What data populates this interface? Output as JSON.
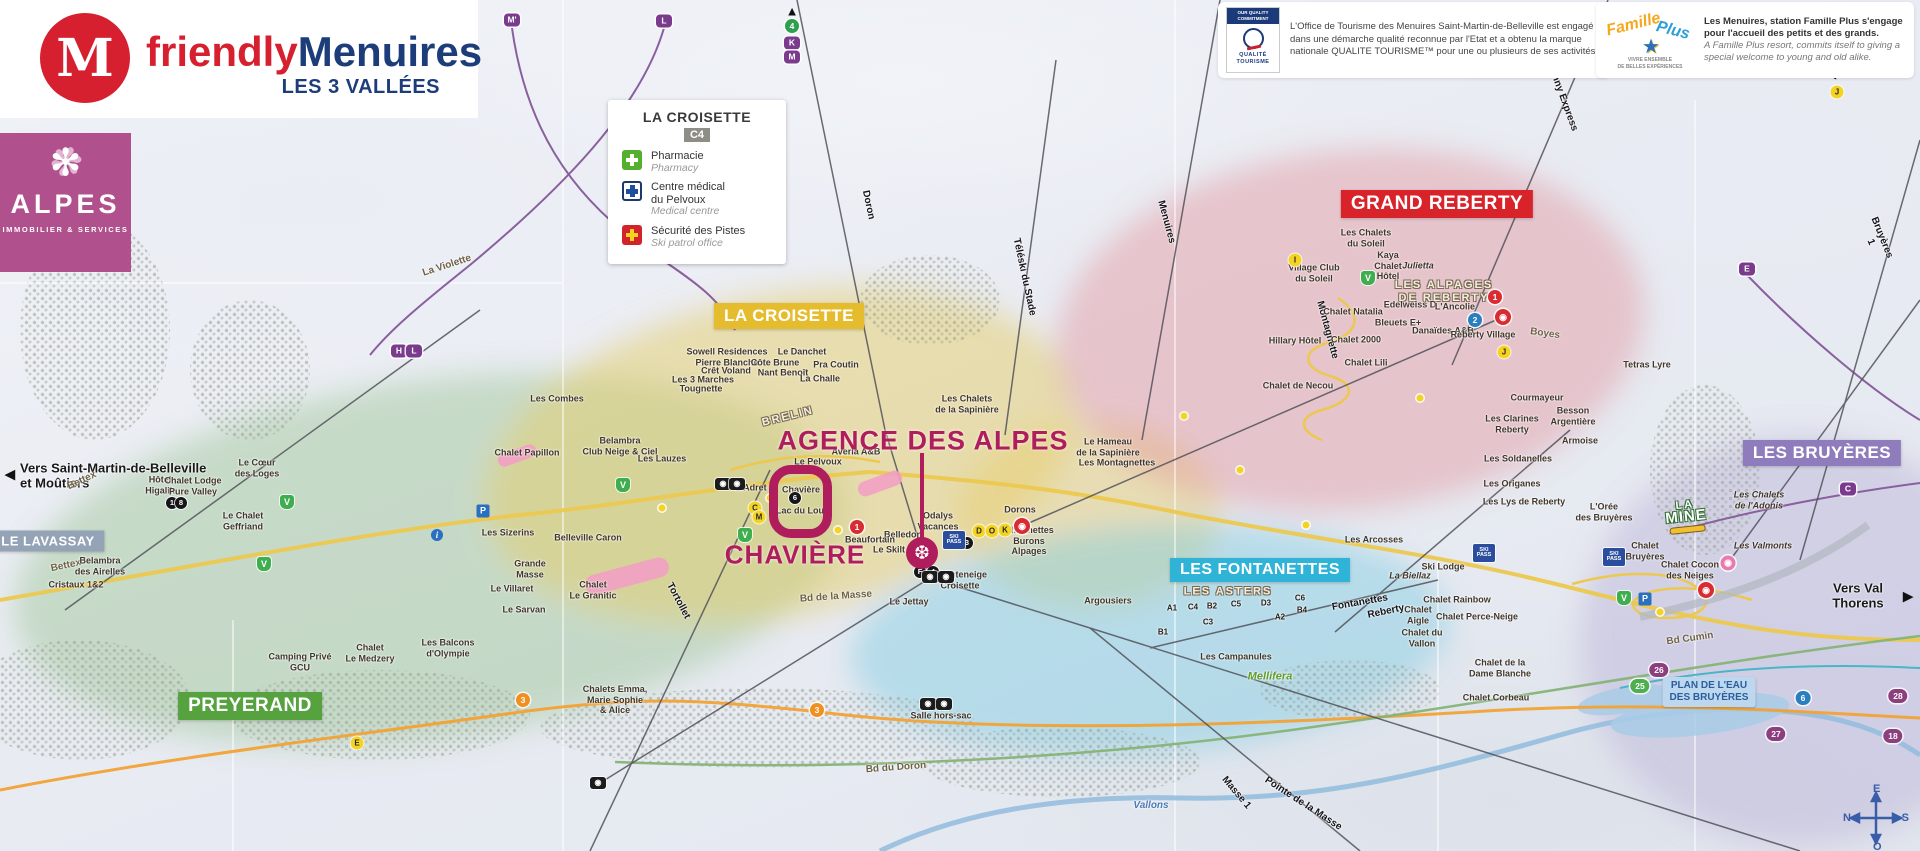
{
  "brand": {
    "logo_letter": "M",
    "friendly": "friendly",
    "menuires": "Menuires",
    "tagline": "LES 3 VALLÉES"
  },
  "alpes": {
    "name": "ALPES",
    "subtitle": "IMMOBILIER & SERVICES"
  },
  "legend": {
    "title": "LA CROISETTE",
    "grid": "C4",
    "items": [
      {
        "icon": "pharmacy-cross",
        "fr": "Pharmacie",
        "en": "Pharmacy"
      },
      {
        "icon": "medical-cross",
        "fr": "Centre médical\ndu Pelvoux",
        "en": "Medical centre"
      },
      {
        "icon": "ski-patrol-cross",
        "fr": "Sécurité des Pistes",
        "en": "Ski patrol office"
      }
    ]
  },
  "quality": {
    "header": "OUR QUALITY COMMITMENT",
    "logo": "QUALITÉ TOURISME",
    "text": "L'Office de Tourisme des Menuires Saint-Martin-de-Belleville est engagé dans une démarche qualité reconnue par l'Etat et a obtenu la marque nationale QUALITE TOURISME™ pour une ou plusieurs de ses activités."
  },
  "famille": {
    "logo_fam": "Famille",
    "logo_plus": "Plus",
    "logo_star": "★",
    "logo_sub": "VIVRE ENSEMBLE\nDE BELLES EXPÉRIENCES",
    "text_fr": "Les Menuires, station Famille Plus s'engage pour l'accueil des petits et des grands.",
    "text_en": "A Famille Plus resort, commits itself to giving a special welcome to young and old alike."
  },
  "annotation": {
    "agency": "AGENCE DES ALPES",
    "district": "CHAVIÈRE",
    "marker_icon": "❆"
  },
  "special": {
    "plan_eau": "PLAN DE L'EAU\nDES BRUYÈRES",
    "la_mine_1": "LA",
    "la_mine_2": "MINE",
    "mellifera": "Mellifera",
    "compass": {
      "n": "N",
      "e": "E",
      "s": "S",
      "o": "O"
    }
  },
  "zones": [
    {
      "t": "LA CROISETTE",
      "x": 789,
      "y": 316,
      "bg": "#e6bc2f",
      "s": 17
    },
    {
      "t": "GRAND REBERTY",
      "x": 1437,
      "y": 204,
      "bg": "#d8232a",
      "s": 19
    },
    {
      "t": "LES BRUYÈRES",
      "x": 1822,
      "y": 453,
      "bg": "#8f7cbc",
      "s": 17
    },
    {
      "t": "LES FONTANETTES",
      "x": 1260,
      "y": 570,
      "bg": "#2fb4d8",
      "s": 16
    },
    {
      "t": "PREYERAND",
      "x": 250,
      "y": 706,
      "bg": "#55a23e",
      "s": 19
    },
    {
      "t": "LE LAVASSAY",
      "x": 48,
      "y": 541,
      "bg": "#95a3b6",
      "s": 13
    }
  ],
  "labels": [
    {
      "t": "Vers Saint-Martin-de-Belleville\net Moûtiers",
      "x": 20,
      "y": 476,
      "cls": "left bold13"
    },
    {
      "t": "Vers Val Thorens",
      "x": 1858,
      "y": 596,
      "cls": "bold13"
    },
    {
      "t": "La Violette",
      "x": 447,
      "y": 266,
      "cls": "road",
      "rot": -18
    },
    {
      "t": "Bettex",
      "x": 82,
      "y": 481,
      "cls": "road",
      "rot": -25
    },
    {
      "t": "Bettex",
      "x": 66,
      "y": 566,
      "cls": "road",
      "rot": -12
    },
    {
      "t": "Doron",
      "x": 868,
      "y": 205,
      "cls": "lift",
      "rot": 78
    },
    {
      "t": "Menuires",
      "x": 1166,
      "y": 222,
      "cls": "lift",
      "rot": 75
    },
    {
      "t": "Téléski du Stade",
      "x": 1024,
      "y": 277,
      "cls": "lift",
      "rot": 78
    },
    {
      "t": "Sunny Express",
      "x": 1562,
      "y": 97,
      "cls": "lift",
      "rot": 70
    },
    {
      "t": "Bruyères 1",
      "x": 1876,
      "y": 240,
      "cls": "lift",
      "rot": 68
    },
    {
      "t": "Tortollet",
      "x": 678,
      "y": 601,
      "cls": "lift",
      "rot": 62
    },
    {
      "t": "Masse 1",
      "x": 1236,
      "y": 793,
      "cls": "lift",
      "rot": 50
    },
    {
      "t": "Pointe de la Masse",
      "x": 1303,
      "y": 804,
      "cls": "lift",
      "rot": 33
    },
    {
      "t": "Fontanettes",
      "x": 1360,
      "y": 603,
      "cls": "lift",
      "rot": -10
    },
    {
      "t": "Reberty",
      "x": 1386,
      "y": 612,
      "cls": "lift",
      "rot": -12
    },
    {
      "t": "Montagnette",
      "x": 1327,
      "y": 330,
      "cls": "lift",
      "rot": 75
    },
    {
      "t": "Bd de la Masse",
      "x": 836,
      "y": 597,
      "cls": "road",
      "rot": -4
    },
    {
      "t": "Bd du Doron",
      "x": 896,
      "y": 768,
      "cls": "road",
      "rot": -4
    },
    {
      "t": "Bd Cumin",
      "x": 1690,
      "y": 639,
      "cls": "road",
      "rot": -8
    },
    {
      "t": "Boyes",
      "x": 1545,
      "y": 334,
      "cls": "road",
      "rot": 8
    },
    {
      "t": "Vallons",
      "x": 1151,
      "y": 806,
      "cls": "river"
    },
    {
      "t": "Sowell Residences\nPierre Blanche",
      "x": 727,
      "y": 357
    },
    {
      "t": "Crêt Voland",
      "x": 726,
      "y": 371
    },
    {
      "t": "Les 3 Marches",
      "x": 703,
      "y": 380
    },
    {
      "t": "Tougnette",
      "x": 701,
      "y": 389
    },
    {
      "t": "Les Combes",
      "x": 557,
      "y": 399
    },
    {
      "t": "Côte Brune",
      "x": 775,
      "y": 363
    },
    {
      "t": "Nant Benoît",
      "x": 783,
      "y": 373
    },
    {
      "t": "Le Danchet",
      "x": 802,
      "y": 352
    },
    {
      "t": "Pra Coutin",
      "x": 836,
      "y": 365
    },
    {
      "t": "La Challe",
      "x": 820,
      "y": 379
    },
    {
      "t": "BRELIN",
      "x": 788,
      "y": 417,
      "cls": "outline",
      "rot": -14
    },
    {
      "t": "Chalet Papillon",
      "x": 527,
      "y": 453
    },
    {
      "t": "Belambra\nClub Neige & Ciel",
      "x": 620,
      "y": 446
    },
    {
      "t": "Les Lauzes",
      "x": 662,
      "y": 459
    },
    {
      "t": "Le Pelvoux",
      "x": 818,
      "y": 462
    },
    {
      "t": "Averia A&B",
      "x": 856,
      "y": 452
    },
    {
      "t": "L'Adret",
      "x": 751,
      "y": 488
    },
    {
      "t": "Chavière",
      "x": 801,
      "y": 490
    },
    {
      "t": "Lac du Lou",
      "x": 800,
      "y": 511
    },
    {
      "t": "Odalys\nVacances",
      "x": 938,
      "y": 521
    },
    {
      "t": "Belledon",
      "x": 903,
      "y": 535
    },
    {
      "t": "Beaufortain",
      "x": 870,
      "y": 540
    },
    {
      "t": "Le Skilt",
      "x": 889,
      "y": 550
    },
    {
      "t": "Dorons",
      "x": 1020,
      "y": 510
    },
    {
      "t": "Charmettes\nBurons\nAlpages",
      "x": 1029,
      "y": 541
    },
    {
      "t": "Chanteneige\nCroisette",
      "x": 960,
      "y": 580
    },
    {
      "t": "Le Jettay",
      "x": 909,
      "y": 602
    },
    {
      "t": "Salle hors-sac",
      "x": 941,
      "y": 716
    },
    {
      "t": "Le Cœur\ndes Loges",
      "x": 257,
      "y": 468
    },
    {
      "t": "Hôtel\nHigalik",
      "x": 160,
      "y": 485
    },
    {
      "t": "Chalet Lodge\nPure Valley",
      "x": 193,
      "y": 486
    },
    {
      "t": "Le Chalet\nGeffriand",
      "x": 243,
      "y": 521
    },
    {
      "t": "Les Sizerins",
      "x": 508,
      "y": 533
    },
    {
      "t": "Belleville Caron",
      "x": 588,
      "y": 538
    },
    {
      "t": "Grande\nMasse",
      "x": 530,
      "y": 569
    },
    {
      "t": "Le Villaret",
      "x": 512,
      "y": 589
    },
    {
      "t": "Chalet\nLe Granitic",
      "x": 593,
      "y": 590
    },
    {
      "t": "Le Sarvan",
      "x": 524,
      "y": 610
    },
    {
      "t": "Belambra\ndes Airelles",
      "x": 100,
      "y": 566
    },
    {
      "t": "Cristaux 1&2",
      "x": 76,
      "y": 585
    },
    {
      "t": "Camping Privé\nGCU",
      "x": 300,
      "y": 662
    },
    {
      "t": "Les Balcons\nd'Olympie",
      "x": 448,
      "y": 648
    },
    {
      "t": "Chalet\nLe Medzery",
      "x": 370,
      "y": 653
    },
    {
      "t": "Chalets Emma,\nMarie Sophie\n& Alice",
      "x": 615,
      "y": 700
    },
    {
      "t": "LES ASTERS",
      "x": 1228,
      "y": 592,
      "cls": "outline"
    },
    {
      "t": "Les Campanules",
      "x": 1236,
      "y": 657
    },
    {
      "t": "Argousiers",
      "x": 1108,
      "y": 601
    },
    {
      "t": "A1",
      "x": 1172,
      "y": 608,
      "cls": "tiny"
    },
    {
      "t": "C4",
      "x": 1193,
      "y": 607,
      "cls": "tiny"
    },
    {
      "t": "B2",
      "x": 1212,
      "y": 606,
      "cls": "tiny"
    },
    {
      "t": "C5",
      "x": 1236,
      "y": 604,
      "cls": "tiny"
    },
    {
      "t": "D3",
      "x": 1266,
      "y": 603,
      "cls": "tiny"
    },
    {
      "t": "C6",
      "x": 1300,
      "y": 598,
      "cls": "tiny"
    },
    {
      "t": "C3",
      "x": 1208,
      "y": 622,
      "cls": "tiny"
    },
    {
      "t": "A2",
      "x": 1280,
      "y": 617,
      "cls": "tiny"
    },
    {
      "t": "B4",
      "x": 1302,
      "y": 610,
      "cls": "tiny"
    },
    {
      "t": "B1",
      "x": 1163,
      "y": 632,
      "cls": "tiny"
    },
    {
      "t": "Les Arcosses",
      "x": 1374,
      "y": 540
    },
    {
      "t": "La Biellaz",
      "x": 1410,
      "y": 576,
      "cls": "italic"
    },
    {
      "t": "Chalet\nAigle",
      "x": 1418,
      "y": 615
    },
    {
      "t": "Chalet du\nVallon",
      "x": 1422,
      "y": 638
    },
    {
      "t": "Les Chalets\ndu Soleil",
      "x": 1366,
      "y": 238
    },
    {
      "t": "Kaya\nChalet\nHôtel",
      "x": 1388,
      "y": 266
    },
    {
      "t": "Julietta",
      "x": 1418,
      "y": 266,
      "cls": "italic"
    },
    {
      "t": "Village Club\ndu Soleil",
      "x": 1314,
      "y": 273
    },
    {
      "t": "LES ALPAGES\nDE REBERTY",
      "x": 1444,
      "y": 292,
      "cls": "outline"
    },
    {
      "t": "Edelweiss D",
      "x": 1410,
      "y": 305
    },
    {
      "t": "L'Ancolie",
      "x": 1455,
      "y": 307
    },
    {
      "t": "Bleuets E+",
      "x": 1398,
      "y": 323
    },
    {
      "t": "Chalet Natalia",
      "x": 1353,
      "y": 312
    },
    {
      "t": "Danaïdes A&B",
      "x": 1443,
      "y": 331
    },
    {
      "t": "Reberty Village",
      "x": 1483,
      "y": 335
    },
    {
      "t": "Chalet 2000",
      "x": 1356,
      "y": 340
    },
    {
      "t": "Hillary Hôtel",
      "x": 1295,
      "y": 341
    },
    {
      "t": "Chalet Lili",
      "x": 1366,
      "y": 363
    },
    {
      "t": "Chalet de Necou",
      "x": 1298,
      "y": 386
    },
    {
      "t": "Tetras Lyre",
      "x": 1647,
      "y": 365
    },
    {
      "t": "Courmayeur",
      "x": 1537,
      "y": 398
    },
    {
      "t": "Besson\nArgentière",
      "x": 1573,
      "y": 416
    },
    {
      "t": "Les Clarines\nReberty",
      "x": 1512,
      "y": 424
    },
    {
      "t": "Armoise",
      "x": 1580,
      "y": 441
    },
    {
      "t": "Les Soldanelles",
      "x": 1518,
      "y": 459
    },
    {
      "t": "Les Origanes",
      "x": 1512,
      "y": 484
    },
    {
      "t": "Les Lys de Reberty",
      "x": 1524,
      "y": 502
    },
    {
      "t": "Les Chalets\nde la Sapinière",
      "x": 967,
      "y": 404
    },
    {
      "t": "Le Hameau\nde la Sapinière",
      "x": 1108,
      "y": 447
    },
    {
      "t": "Les Montagnettes",
      "x": 1117,
      "y": 463
    },
    {
      "t": "Les Chalets\nde l'Adonis",
      "x": 1759,
      "y": 500,
      "cls": "italic"
    },
    {
      "t": "Les Valmonts",
      "x": 1763,
      "y": 546,
      "cls": "italic"
    },
    {
      "t": "Chalet Cocon\ndes Neiges",
      "x": 1690,
      "y": 570
    },
    {
      "t": "Chalet\nBruyères",
      "x": 1645,
      "y": 551
    },
    {
      "t": "L'Orée\ndes Bruyères",
      "x": 1604,
      "y": 512
    },
    {
      "t": "Chalet de la\nDame Blanche",
      "x": 1500,
      "y": 668
    },
    {
      "t": "Chalet Corbeau",
      "x": 1496,
      "y": 698
    },
    {
      "t": "Ski Lodge",
      "x": 1443,
      "y": 567
    },
    {
      "t": "Chalet Rainbow",
      "x": 1457,
      "y": 600
    },
    {
      "t": "Chalet Perce-Neige",
      "x": 1477,
      "y": 617
    },
    {
      "t": "Mellifera",
      "x": 1270,
      "y": 677,
      "cls": "green"
    }
  ],
  "badges": [
    {
      "ty": "letter",
      "t": "M'",
      "x": 512,
      "y": 20
    },
    {
      "ty": "letter",
      "t": "L",
      "x": 664,
      "y": 21
    },
    {
      "ty": "letter",
      "t": "K",
      "x": 792,
      "y": 43
    },
    {
      "ty": "letter",
      "t": "M",
      "x": 792,
      "y": 57
    },
    {
      "ty": "letter",
      "t": "H",
      "x": 399,
      "y": 351
    },
    {
      "ty": "letter",
      "t": "L",
      "x": 414,
      "y": 351
    },
    {
      "ty": "letter",
      "t": "E",
      "x": 1747,
      "y": 269
    },
    {
      "ty": "letter",
      "t": "C",
      "x": 1848,
      "y": 489
    },
    {
      "ty": "cg",
      "t": "4",
      "x": 792,
      "y": 26
    },
    {
      "ty": "pillp",
      "t": "26",
      "x": 1659,
      "y": 670
    },
    {
      "ty": "pillp",
      "t": "27",
      "x": 1776,
      "y": 734
    },
    {
      "ty": "pillp",
      "t": "28",
      "x": 1898,
      "y": 696
    },
    {
      "ty": "pillp",
      "t": "18",
      "x": 1893,
      "y": 736
    },
    {
      "ty": "pillg",
      "t": "25",
      "x": 1640,
      "y": 686
    },
    {
      "ty": "pillb",
      "t": "6",
      "x": 1803,
      "y": 698
    },
    {
      "ty": "cr",
      "t": "1",
      "x": 1495,
      "y": 297
    },
    {
      "ty": "cr",
      "t": "1",
      "x": 857,
      "y": 527
    },
    {
      "ty": "cb",
      "t": "2",
      "x": 1475,
      "y": 320
    },
    {
      "ty": "co",
      "t": "3",
      "x": 817,
      "y": 710
    },
    {
      "ty": "co",
      "t": "3",
      "x": 523,
      "y": 700
    },
    {
      "ty": "ck",
      "t": "1",
      "x": 172,
      "y": 503
    },
    {
      "ty": "ck",
      "t": "8",
      "x": 181,
      "y": 503
    },
    {
      "ty": "ck",
      "t": "6",
      "x": 795,
      "y": 498
    },
    {
      "ty": "ck",
      "t": "3",
      "x": 967,
      "y": 543
    },
    {
      "ty": "ck",
      "t": "4",
      "x": 933,
      "y": 572
    },
    {
      "ty": "ck",
      "t": "F",
      "x": 920,
      "y": 572
    },
    {
      "ty": "cy",
      "t": "I",
      "x": 1295,
      "y": 260
    },
    {
      "ty": "cy",
      "t": "J",
      "x": 1504,
      "y": 352
    },
    {
      "ty": "cy",
      "t": "J",
      "x": 1837,
      "y": 92
    },
    {
      "ty": "cy",
      "t": "E",
      "x": 357,
      "y": 743
    },
    {
      "ty": "cy",
      "t": "D",
      "x": 979,
      "y": 531
    },
    {
      "ty": "cy",
      "t": "O",
      "x": 992,
      "y": 531
    },
    {
      "ty": "cy",
      "t": "K",
      "x": 1005,
      "y": 530
    },
    {
      "ty": "cy",
      "t": "C",
      "x": 755,
      "y": 508
    },
    {
      "ty": "cy",
      "t": "M",
      "x": 759,
      "y": 517
    },
    {
      "ty": "shield",
      "t": "V",
      "x": 1368,
      "y": 278
    },
    {
      "ty": "shield",
      "t": "V",
      "x": 264,
      "y": 564
    },
    {
      "ty": "shield",
      "t": "V",
      "x": 287,
      "y": 502
    },
    {
      "ty": "shield",
      "t": "V",
      "x": 623,
      "y": 485
    },
    {
      "ty": "shield",
      "t": "V",
      "x": 745,
      "y": 535
    },
    {
      "ty": "shield",
      "t": "V",
      "x": 1624,
      "y": 598
    },
    {
      "ty": "info",
      "t": "i",
      "x": 437,
      "y": 535
    },
    {
      "ty": "park",
      "t": "P",
      "x": 483,
      "y": 511
    },
    {
      "ty": "park",
      "t": "P",
      "x": 1645,
      "y": 599
    },
    {
      "ty": "ski",
      "t": "SKI\nPASS",
      "x": 954,
      "y": 540
    },
    {
      "ty": "ski",
      "t": "SKI\nPASS",
      "x": 1484,
      "y": 553
    },
    {
      "ty": "ski",
      "t": "SKI\nPASS",
      "x": 1614,
      "y": 557
    },
    {
      "ty": "liftb",
      "t": "◉",
      "x": 723,
      "y": 484
    },
    {
      "ty": "liftb",
      "t": "◉",
      "x": 737,
      "y": 484
    },
    {
      "ty": "liftb",
      "t": "◉",
      "x": 930,
      "y": 577
    },
    {
      "ty": "liftb",
      "t": "◉",
      "x": 946,
      "y": 577
    },
    {
      "ty": "liftb",
      "t": "◉",
      "x": 928,
      "y": 704
    },
    {
      "ty": "liftb",
      "t": "◉",
      "x": 944,
      "y": 704
    },
    {
      "ty": "liftb",
      "t": "◉",
      "x": 598,
      "y": 783
    },
    {
      "ty": "gr",
      "t": "◉",
      "x": 1022,
      "y": 526
    },
    {
      "ty": "gr",
      "t": "◉",
      "x": 1503,
      "y": 317
    },
    {
      "ty": "gr",
      "t": "◉",
      "x": 1706,
      "y": 590
    },
    {
      "ty": "gp",
      "t": "◉",
      "x": 1728,
      "y": 563
    },
    {
      "ty": "arrow",
      "t": "◀",
      "x": 10,
      "y": 474
    },
    {
      "ty": "arrow",
      "t": "▶",
      "x": 1908,
      "y": 596
    },
    {
      "ty": "arrow",
      "t": "◀",
      "x": 1831,
      "y": 73
    },
    {
      "ty": "arrow",
      "t": "▲",
      "x": 792,
      "y": 11
    },
    {
      "ty": "dot",
      "x": 662,
      "y": 508
    },
    {
      "ty": "dot",
      "x": 770,
      "y": 498
    },
    {
      "ty": "dot",
      "x": 838,
      "y": 530
    },
    {
      "ty": "dot",
      "x": 1240,
      "y": 470
    },
    {
      "ty": "dot",
      "x": 1420,
      "y": 398
    },
    {
      "ty": "dot",
      "x": 1306,
      "y": 525
    },
    {
      "ty": "dot",
      "x": 1660,
      "y": 612
    },
    {
      "ty": "dot",
      "x": 1184,
      "y": 416
    }
  ]
}
